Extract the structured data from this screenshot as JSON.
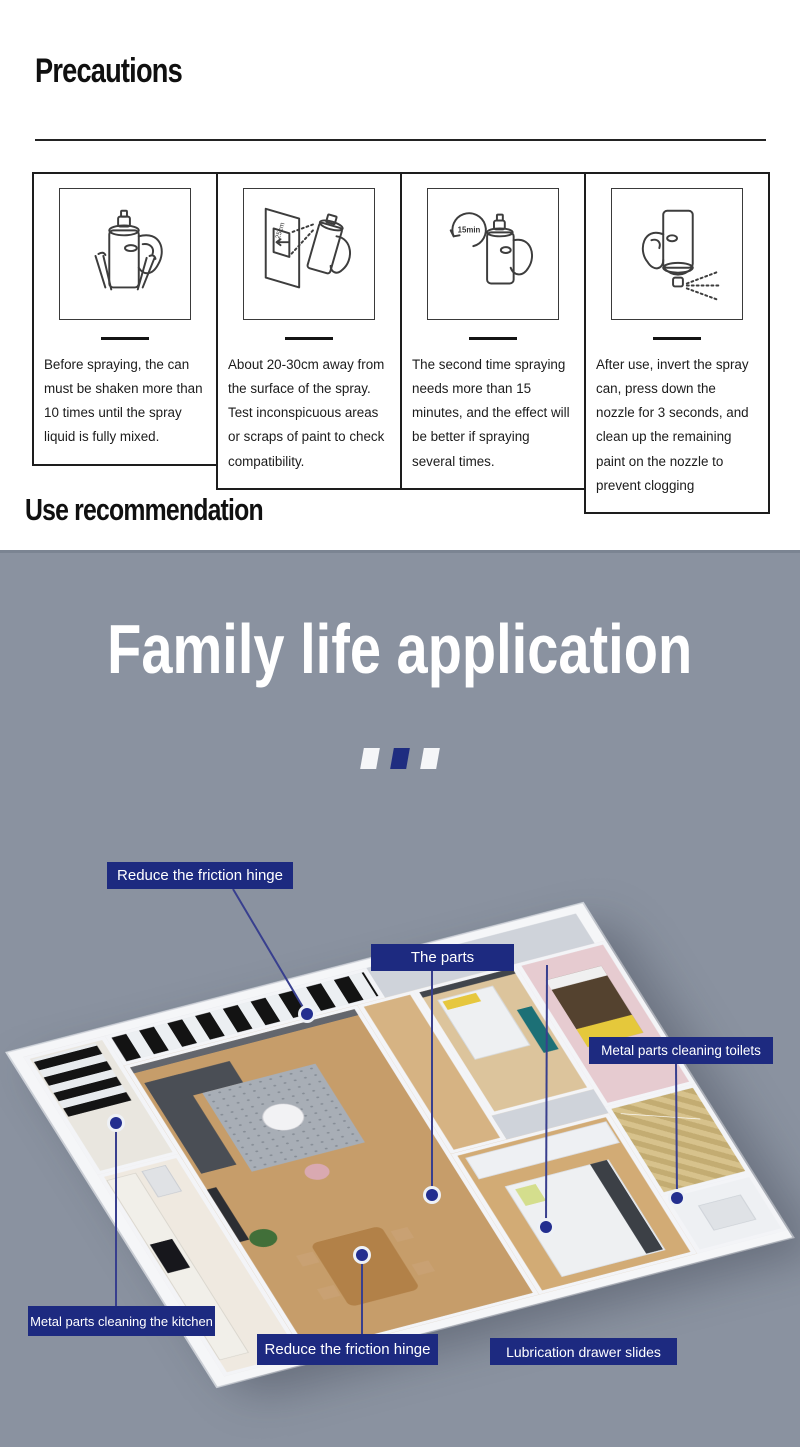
{
  "colors": {
    "section_gray": "#8a92a0",
    "label_navy": "#1d2a80",
    "dot_navy": "#232e8f",
    "heading_black": "#101010",
    "title_white": "#ffffff"
  },
  "precautions": {
    "heading": "Precautions",
    "panels": [
      {
        "icon": "shake-spray-can-illustration",
        "caption": "Before spraying, the can must be shaken more than 10 times until the spray liquid is fully mixed."
      },
      {
        "icon": "spray-distance-illustration",
        "distance_label": "25cm",
        "caption": "About 20-30cm away from the surface of the spray. Test inconspicuous areas or scraps of paint to check compatibility."
      },
      {
        "icon": "wait-15-minutes-illustration",
        "timer_label": "15min",
        "caption": "The second time spraying needs more than 15 minutes, and the effect will be better if spraying several times."
      },
      {
        "icon": "invert-can-clean-nozzle-illustration",
        "caption": "After use, invert the spray can, press down the nozzle for 3 seconds, and clean up the remaining paint on the nozzle to prevent clogging"
      }
    ]
  },
  "use_recommendation": {
    "heading": "Use recommendation"
  },
  "family_section": {
    "title": "Family life application",
    "callouts": [
      {
        "label": "Reduce the friction hinge"
      },
      {
        "label": "The parts"
      },
      {
        "label": "Metal parts cleaning toilets"
      },
      {
        "label": "Metal parts cleaning the kitchen"
      },
      {
        "label": "Reduce the friction hinge"
      },
      {
        "label": "Lubrication drawer slides"
      }
    ]
  }
}
